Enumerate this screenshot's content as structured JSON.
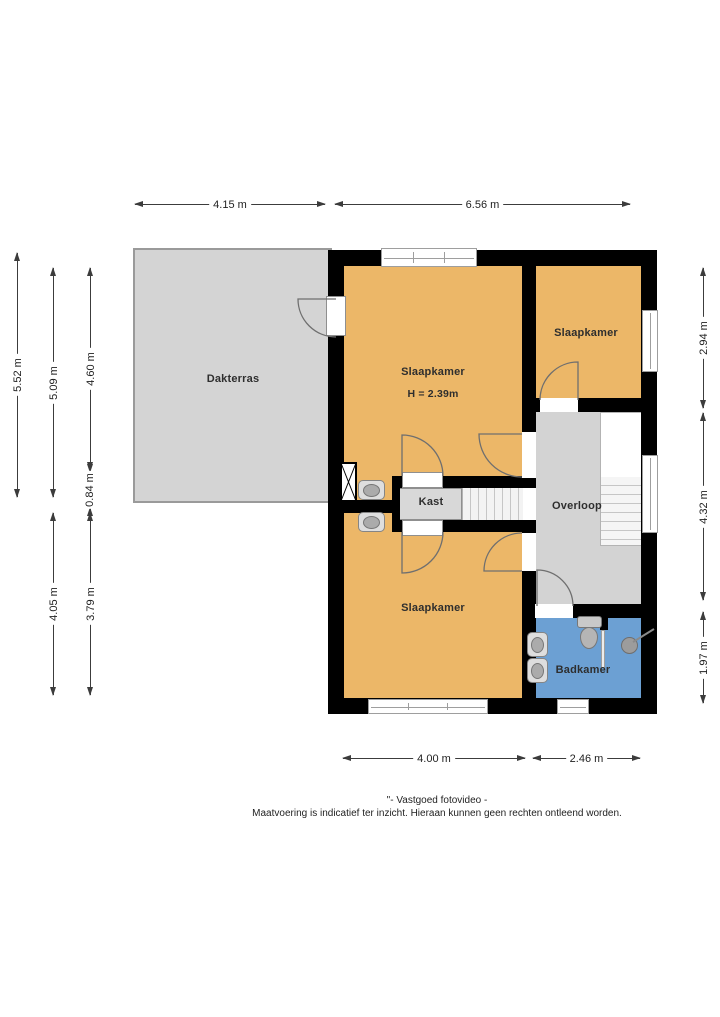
{
  "rooms": {
    "dakterras": "Dakterras",
    "slaapkamer_main": "Slaapkamer",
    "slaapkamer_main_height": "H = 2.39m",
    "slaapkamer_right": "Slaapkamer",
    "slaapkamer_bottom": "Slaapkamer",
    "kast": "Kast",
    "overloop": "Overloop",
    "badkamer": "Badkamer"
  },
  "dimensions": {
    "top": [
      "4.15 m",
      "6.56 m"
    ],
    "left": [
      "5.52 m",
      "5.09 m",
      "4.60 m",
      "0.84 m",
      "4.05 m",
      "3.79 m"
    ],
    "right": [
      "2.94 m",
      "4.32 m",
      "1.97 m"
    ],
    "bottom": [
      "4.00 m",
      "2.46 m"
    ]
  },
  "footer": {
    "line1": "\"- Vastgoed fotovideo -",
    "line2": "Maatvoering is indicatief ter inzicht. Hieraan kunnen geen rechten ontleend worden."
  },
  "colors": {
    "wall": "#000000",
    "bedroom": "#ECB768",
    "terrace": "#D4D4D4",
    "hall": "#D3D3D3",
    "closet": "#D8D8D8",
    "bathroom": "#6CA0D3"
  }
}
